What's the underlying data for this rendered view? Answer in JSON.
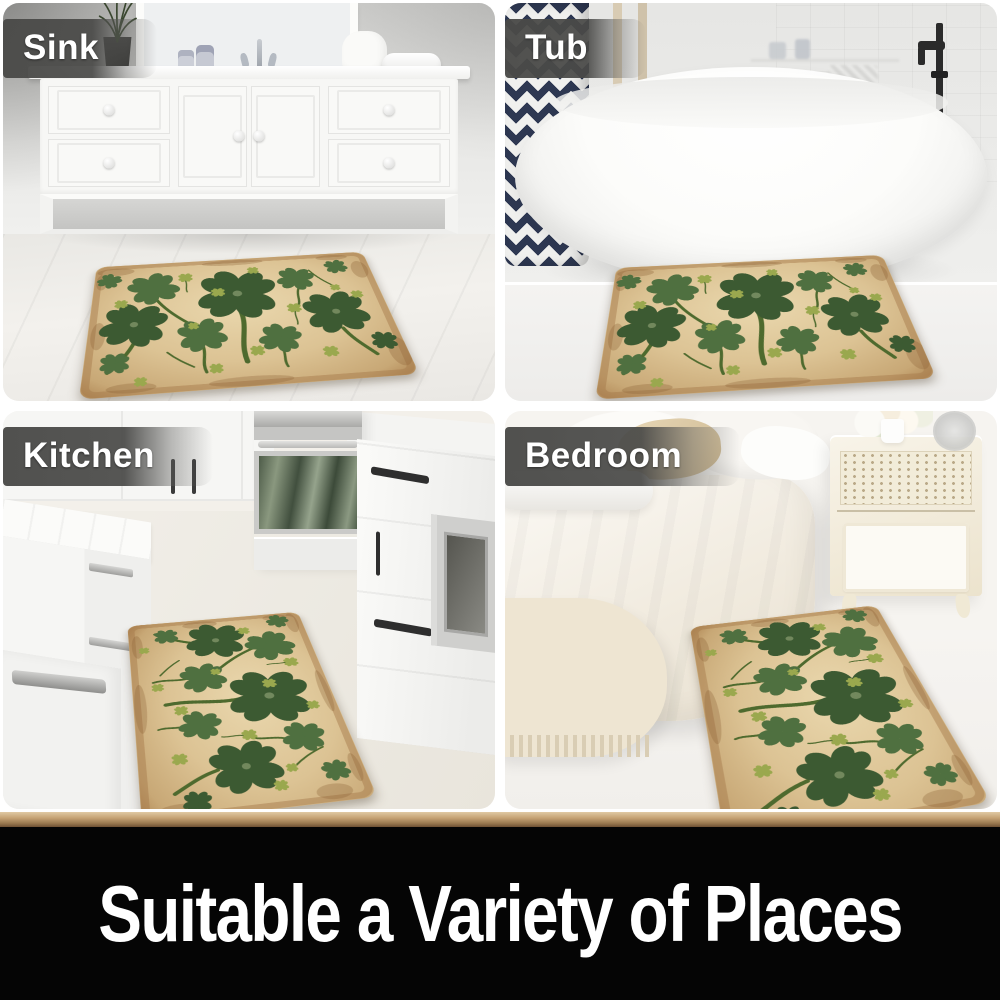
{
  "panels": [
    {
      "id": "sink",
      "label": "Sink"
    },
    {
      "id": "tub",
      "label": "Tub"
    },
    {
      "id": "kitchen",
      "label": "Kitchen"
    },
    {
      "id": "bedroom",
      "label": "Bedroom"
    }
  ],
  "banner": {
    "text": "Suitable a Variety of Places"
  },
  "colors": {
    "label_bg": "#4a4a48",
    "label_text": "#ffffff",
    "banner_bg": "#050505",
    "banner_text": "#ffffff",
    "divider_light": "#e0c9a4",
    "divider_mid": "#c5a274",
    "divider_dark": "#6e5134",
    "mat_center": "#ead8ae",
    "mat_base": "#dcc394",
    "mat_edge": "#a5784a",
    "clover_dark": "#3c5a32",
    "clover_mid": "#4f7040",
    "clover_light": "#9aa84e",
    "stem": "#4e6a2e",
    "towel_navy": "#2e3852"
  }
}
